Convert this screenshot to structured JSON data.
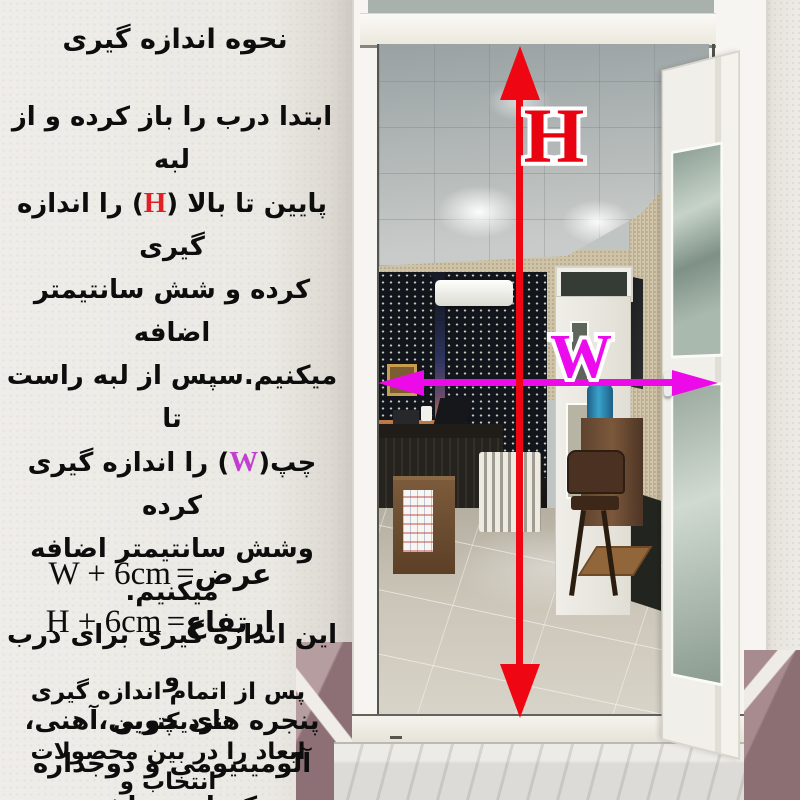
{
  "title": "نحوه اندازه گیری",
  "instructions": {
    "line1": "ابتدا درب را باز کرده و از لبه",
    "line2_pre": "پایین تا بالا (",
    "line2_mark": "H",
    "line2_post": ") را اندازه گیری",
    "line3": "کرده و شش سانتیمتر اضافه",
    "line4": "میکنیم.سپس از لبه راست تا",
    "line5_pre": "چپ(",
    "line5_mark": "W",
    "line5_post": ") را اندازه گیری کرده",
    "line6": "وشش سانتیمتر اضافه میکنیم.",
    "line7": "این اندازه گیری برای درب و",
    "line8": "پنجره های چوبی،آهنی،",
    "line9": "آلومینیومی و دوجداره",
    "line10": "یکسان میباشد."
  },
  "formulas": {
    "width": {
      "label": "عرض",
      "equals": "=",
      "expr": "W + 6cm"
    },
    "height": {
      "label": "ارتفاع",
      "equals": "=",
      "expr": "H + 6cm"
    }
  },
  "footer": {
    "line1": "پس از اتمام اندازه گیری نزدیکترین",
    "line2": "ابعاد را در بین محصولات انتخاب و",
    "line3": "خریداری کنید."
  },
  "measure": {
    "height_label": "H",
    "width_label": "W",
    "height_arrow_color": "#ee0712",
    "width_arrow_color": "#ec0be8",
    "extra_margin": "6cm"
  }
}
